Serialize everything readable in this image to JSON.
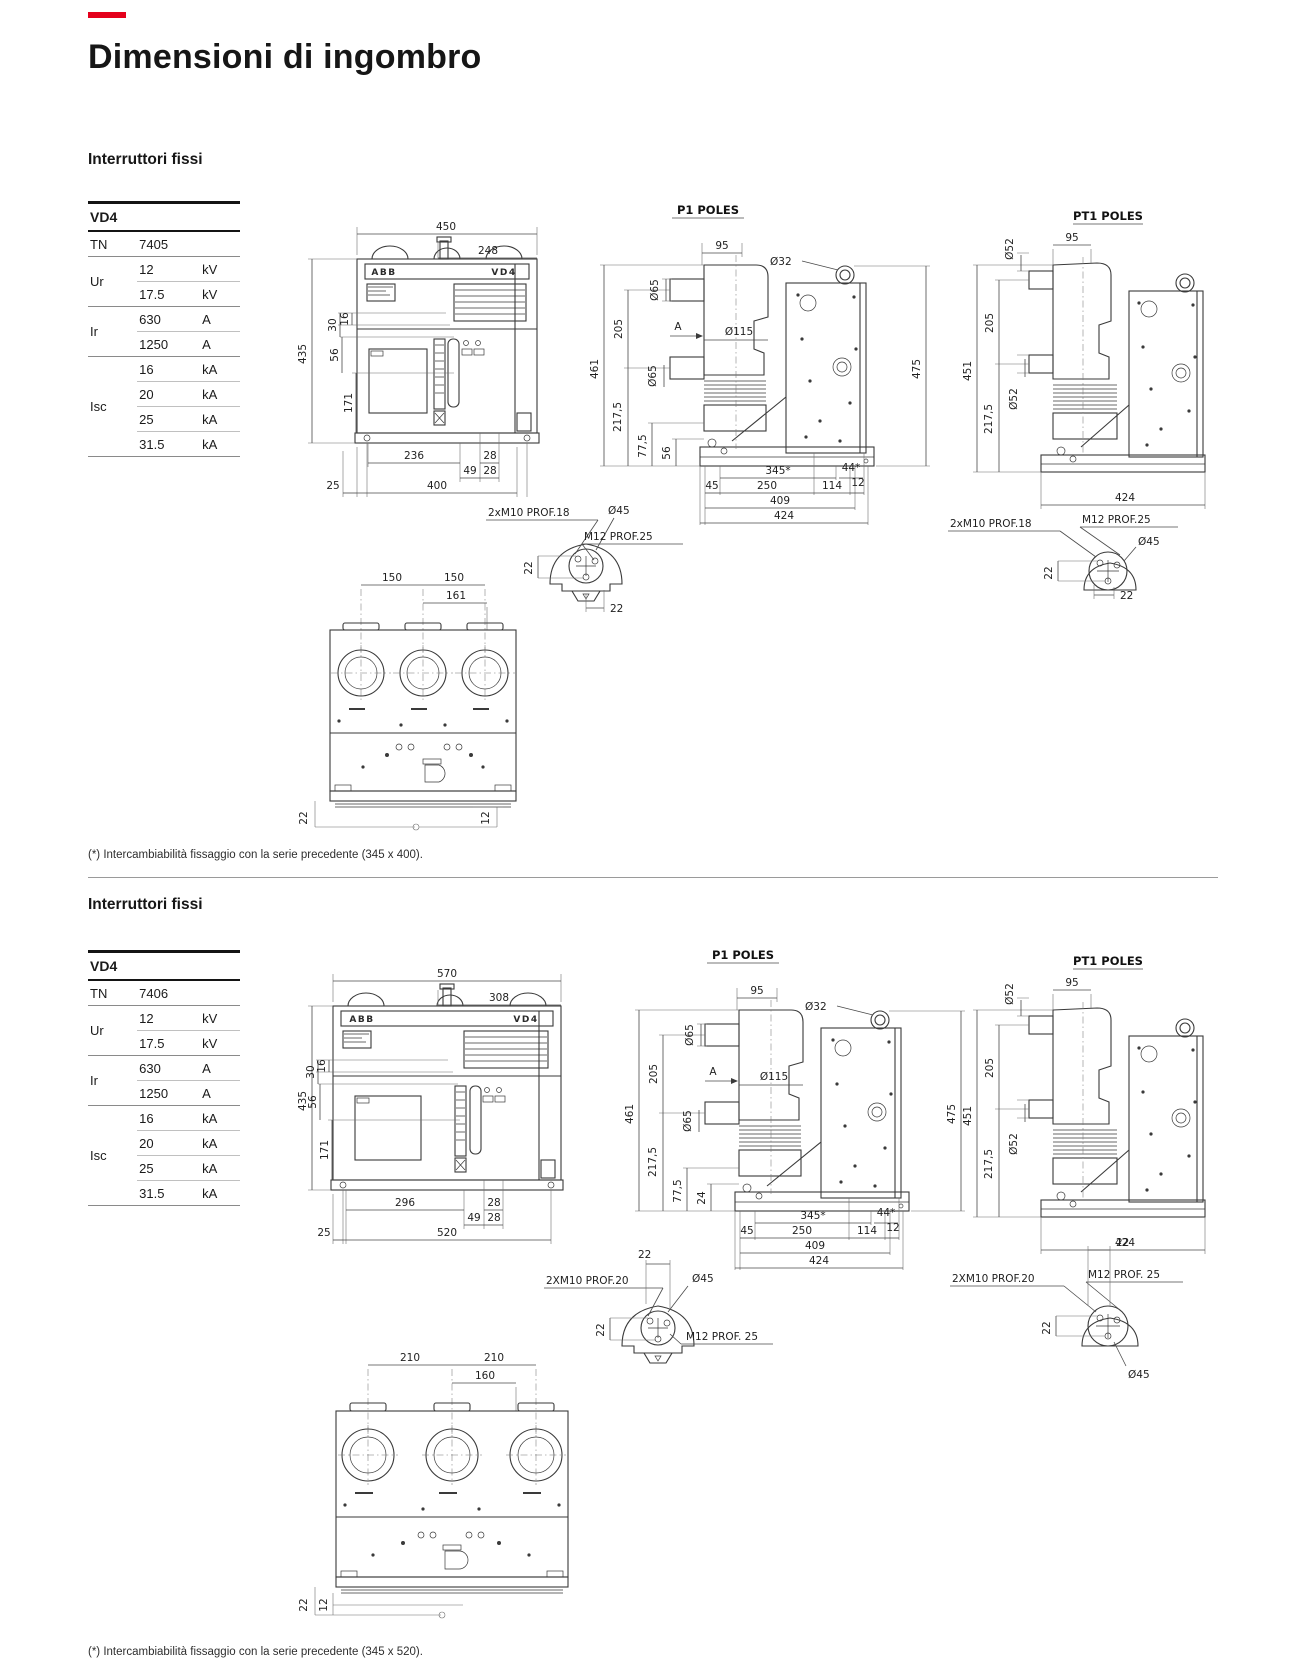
{
  "page": {
    "title": "Dimensioni di ingombro"
  },
  "sections": [
    {
      "heading": "Interruttori fissi",
      "footnote": "(*) Intercambiabilità fissaggio con la serie precedente (345 x 400).",
      "table": {
        "title": "VD4",
        "tn_label": "TN",
        "tn_value": "7405",
        "groups": [
          {
            "label": "Ur",
            "rows": [
              {
                "v": "12",
                "u": "kV"
              },
              {
                "v": "17.5",
                "u": "kV"
              }
            ]
          },
          {
            "label": "Ir",
            "rows": [
              {
                "v": "630",
                "u": "A"
              },
              {
                "v": "1250",
                "u": "A"
              }
            ]
          },
          {
            "label": "Isc",
            "rows": [
              {
                "v": "16",
                "u": "kA"
              },
              {
                "v": "20",
                "u": "kA"
              },
              {
                "v": "25",
                "u": "kA"
              },
              {
                "v": "31.5",
                "u": "kA"
              }
            ]
          }
        ]
      },
      "front": {
        "brand": "ABB",
        "model": "VD4",
        "w": "450",
        "wi": "248",
        "h": "435",
        "d30": "30",
        "d16": "16",
        "d56": "56",
        "d171": "171",
        "b1": "236",
        "b2": "28",
        "b3": "49",
        "b4": "28",
        "b5": "25",
        "b6": "400"
      },
      "p1": {
        "title": "P1 POLES",
        "a": "A",
        "d95": "95",
        "dia32": "Ø32",
        "dia65t": "Ø65",
        "dia115": "Ø115",
        "dia65b": "Ø65",
        "d205": "205",
        "d461": "461",
        "d2175": "217,5",
        "d775": "77,5",
        "dfoot": "56",
        "d475": "475",
        "d345": "345*",
        "d44": "44*",
        "d45": "45",
        "d250": "250",
        "d114": "114",
        "d12": "12",
        "d409": "409",
        "d424": "424"
      },
      "pt1": {
        "title": "PT1 POLES",
        "dia52t": "Ø52",
        "d95": "95",
        "d205": "205",
        "d451": "451",
        "d2175": "217,5",
        "dia52b": "Ø52",
        "d424": "424"
      },
      "dl": {
        "bolts": "2xM10 PROF.18",
        "dia45": "Ø45",
        "pin": "M12 PROF.25",
        "d22v": "22",
        "d22h": "22"
      },
      "dr": {
        "bolts": "2xM10 PROF.18",
        "pin": "M12 PROF.25",
        "dia45": "Ø45",
        "d22v": "22",
        "d22h": "22"
      },
      "bv": {
        "dA": "150",
        "dB": "150",
        "dC": "161",
        "d22": "22",
        "d12": "12"
      }
    },
    {
      "heading": "Interruttori fissi",
      "footnote": "(*) Intercambiabilità fissaggio con la serie precedente (345 x 520).",
      "table": {
        "title": "VD4",
        "tn_label": "TN",
        "tn_value": "7406",
        "groups": [
          {
            "label": "Ur",
            "rows": [
              {
                "v": "12",
                "u": "kV"
              },
              {
                "v": "17.5",
                "u": "kV"
              }
            ]
          },
          {
            "label": "Ir",
            "rows": [
              {
                "v": "630",
                "u": "A"
              },
              {
                "v": "1250",
                "u": "A"
              }
            ]
          },
          {
            "label": "Isc",
            "rows": [
              {
                "v": "16",
                "u": "kA"
              },
              {
                "v": "20",
                "u": "kA"
              },
              {
                "v": "25",
                "u": "kA"
              },
              {
                "v": "31.5",
                "u": "kA"
              }
            ]
          }
        ]
      },
      "front": {
        "brand": "ABB",
        "model": "VD4",
        "w": "570",
        "wi": "308",
        "h": "435",
        "d30": "30",
        "d16": "16",
        "d56": "56",
        "d171": "171",
        "b1": "296",
        "b2": "28",
        "b3": "49",
        "b4": "28",
        "b5": "25",
        "b6": "520"
      },
      "p1": {
        "title": "P1 POLES",
        "a": "A",
        "d95": "95",
        "dia32": "Ø32",
        "dia65t": "Ø65",
        "dia115": "Ø115",
        "dia65b": "Ø65",
        "d205": "205",
        "d461": "461",
        "d2175": "217,5",
        "d775": "77,5",
        "dfoot": "24",
        "d475": "475",
        "d345": "345*",
        "d44": "44*",
        "d45": "45",
        "d250": "250",
        "d114": "114",
        "d12": "12",
        "d409": "409",
        "d424": "424"
      },
      "pt1": {
        "title": "PT1 POLES",
        "dia52t": "Ø52",
        "d95": "95",
        "d205": "205",
        "d451": "451",
        "d2175": "217,5",
        "dia52b": "Ø52",
        "d424": "424"
      },
      "dl": {
        "bolts": "2XM10 PROF.20",
        "dia45": "Ø45",
        "pin": "M12 PROF. 25",
        "d22v": "22",
        "d22h": "22"
      },
      "dr": {
        "bolts": "2XM10 PROF.20",
        "pin": "M12 PROF. 25",
        "dia45": "Ø45",
        "d22v": "22",
        "d22h": "22"
      },
      "bv": {
        "dA": "210",
        "dB": "210",
        "dC": "160",
        "d22": "22",
        "d12": "12"
      }
    }
  ]
}
